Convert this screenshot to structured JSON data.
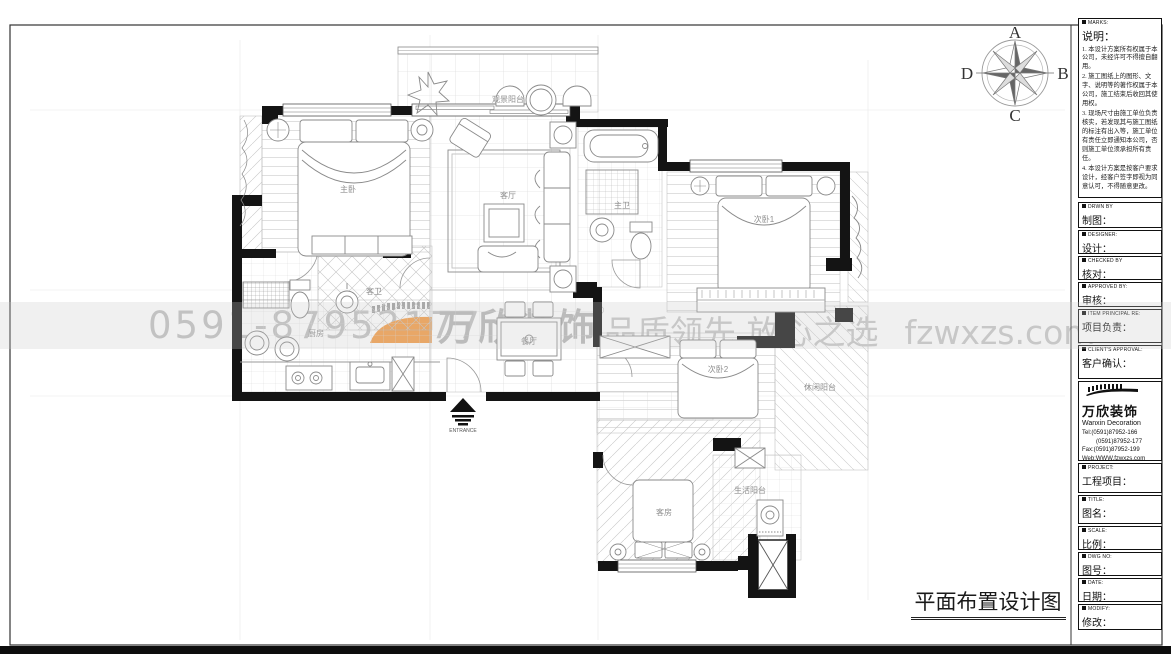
{
  "sheet": {
    "drawing_title": "平面布置设计图",
    "entrance_label": "ENTRANCE"
  },
  "compass": {
    "n": "A",
    "e": "B",
    "s": "C",
    "w": "D"
  },
  "watermark": {
    "phone": "0591-87952177",
    "brand": "万欣装饰",
    "reg": "®",
    "slogan": "品质领先 放心之选",
    "website": "fzwxzs.com",
    "accent_color": "#f49a42"
  },
  "rooms": [
    {
      "name": "观景阳台"
    },
    {
      "name": "主卧"
    },
    {
      "name": "客厅"
    },
    {
      "name": "主卫"
    },
    {
      "name": "次卧1"
    },
    {
      "name": "客卫"
    },
    {
      "name": "厨房"
    },
    {
      "name": "餐厅"
    },
    {
      "name": "次卧2"
    },
    {
      "name": "休闲阳台"
    },
    {
      "name": "客房"
    },
    {
      "name": "生活阳台"
    }
  ],
  "titleblock": {
    "marks": {
      "en": "MARKS:",
      "zh": "说明：",
      "items": [
        "1. 本设计方案所有权属于本公司，未经许可不得擅自翻用。",
        "2. 施工图纸上的图形、文字、说明等的著作权属于本公司，施工结束后收回其使用权。",
        "3. 现场尺寸由施工单位负责核实，若发现其与施工图纸的标注有出入等，施工单位有责任立即通知本公司，否则施工单位须承担所有责任。",
        "4. 本设计方案是按客户要求设计，经客户签字即视为同意认可，不得随意更改。"
      ]
    },
    "fields": [
      {
        "en": "DRWN BY",
        "zh": "制图："
      },
      {
        "en": "DESIGNER:",
        "zh": "设计："
      },
      {
        "en": "CHECKED BY",
        "zh": "核对："
      },
      {
        "en": "APPROVED BY:",
        "zh": "审核："
      },
      {
        "en": "ITEM PRINCIPAL RE:",
        "zh": "项目负责："
      },
      {
        "en": "CLIENT'S APPROVAL:",
        "zh": "客户确认："
      }
    ],
    "company": {
      "brand": "万欣装饰",
      "sub": "Wanxin Decoration",
      "tel1": "Tel:(0591)87952-166",
      "tel2": "(0591)87952-177",
      "fax": "Fax:(0591)87952-199",
      "web": "Web:WWW.fzwxzs.com"
    },
    "fields2": [
      {
        "en": "PROJECT:",
        "zh": "工程项目："
      },
      {
        "en": "TITLE:",
        "zh": "图名："
      },
      {
        "en": "SCALE:",
        "zh": "比例："
      },
      {
        "en": "DWG NO:",
        "zh": "图号："
      },
      {
        "en": "DATE:",
        "zh": "日期："
      },
      {
        "en": "MODIFY:",
        "zh": "修改："
      }
    ]
  }
}
